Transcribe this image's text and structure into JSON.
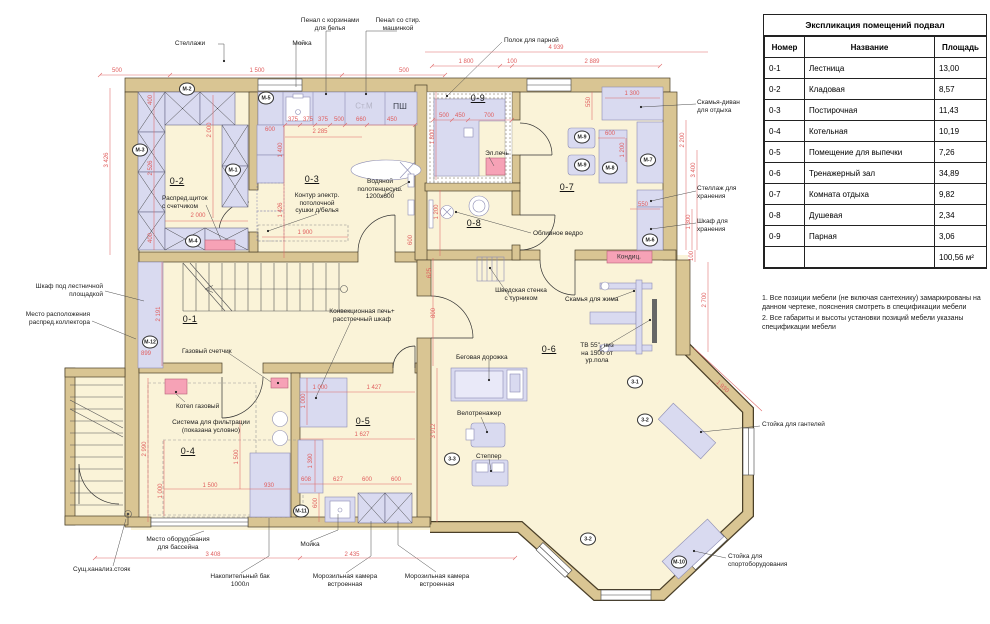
{
  "legend": {
    "title": "Экспликация помещений подвал",
    "columns": [
      "Номер",
      "Название",
      "Площадь"
    ],
    "rows": [
      [
        "0-1",
        "Лестница",
        "13,00"
      ],
      [
        "0-2",
        "Кладовая",
        "8,57"
      ],
      [
        "0-3",
        "Постирочная",
        "11,43"
      ],
      [
        "0-4",
        "Котельная",
        "10,19"
      ],
      [
        "0-5",
        "Помещение для выпечки",
        "7,26"
      ],
      [
        "0-6",
        "Тренажерный зал",
        "34,89"
      ],
      [
        "0-7",
        "Комната отдыха",
        "9,82"
      ],
      [
        "0-8",
        "Душевая",
        "2,34"
      ],
      [
        "0-9",
        "Парная",
        "3,06"
      ]
    ],
    "total": "100,56 м²"
  },
  "notes": [
    "1. Все позиции мебели (не включая сантехнику) замаркированы на данном чертеже, пояснения смотреть в спецификации мебели",
    "2. Все габариты и высоты установки позиций мебели указаны спецификации мебели"
  ],
  "colors": {
    "wall": "#d9c593",
    "floor": "#faf3d8",
    "furniture": "#d9daf0",
    "equipment_pink": "#f6a2b6",
    "dimension_red": "#e05d5d"
  },
  "plan": {
    "room_labels": [
      {
        "t": "0-1",
        "x": 190,
        "y": 314
      },
      {
        "t": "0-2",
        "x": 177,
        "y": 176
      },
      {
        "t": "0-3",
        "x": 312,
        "y": 174
      },
      {
        "t": "0-4",
        "x": 188,
        "y": 446
      },
      {
        "t": "0-5",
        "x": 363,
        "y": 416
      },
      {
        "t": "0-6",
        "x": 549,
        "y": 344
      },
      {
        "t": "0-7",
        "x": 567,
        "y": 182
      },
      {
        "t": "0-8",
        "x": 474,
        "y": 218
      },
      {
        "t": "0-9",
        "x": 478,
        "y": 93
      }
    ],
    "marks": [
      {
        "t": "М-1",
        "x": 233,
        "y": 170
      },
      {
        "t": "М-2",
        "x": 187,
        "y": 89
      },
      {
        "t": "М-3",
        "x": 140,
        "y": 150
      },
      {
        "t": "М-4",
        "x": 193,
        "y": 241
      },
      {
        "t": "М-5",
        "x": 266,
        "y": 98
      },
      {
        "t": "М-6",
        "x": 650,
        "y": 240
      },
      {
        "t": "М-7",
        "x": 648,
        "y": 160
      },
      {
        "t": "М-8",
        "x": 610,
        "y": 168
      },
      {
        "t": "М-9",
        "x": 582,
        "y": 137
      },
      {
        "t": "М-9",
        "x": 582,
        "y": 165
      },
      {
        "t": "М-10",
        "x": 679,
        "y": 562
      },
      {
        "t": "М-11",
        "x": 301,
        "y": 511
      },
      {
        "t": "М-12",
        "x": 150,
        "y": 342
      },
      {
        "t": "3-1",
        "x": 635,
        "y": 382
      },
      {
        "t": "3-2",
        "x": 645,
        "y": 420
      },
      {
        "t": "3-2",
        "x": 588,
        "y": 539
      },
      {
        "t": "3-3",
        "x": 452,
        "y": 459
      }
    ],
    "labels": [
      {
        "t": "Стеллажи",
        "x": 190,
        "y": 40,
        "a": "c"
      },
      {
        "t": "Пенал с корзинами\nдля белья",
        "x": 330,
        "y": 17,
        "a": "c"
      },
      {
        "t": "Пенал со стир.\nмашинкой",
        "x": 398,
        "y": 17,
        "a": "c"
      },
      {
        "t": "Мойка",
        "x": 302,
        "y": 40,
        "a": "c"
      },
      {
        "t": "Полок для парной",
        "x": 504,
        "y": 37,
        "a": "l"
      },
      {
        "t": "Скамья-диван\nдля отдыха",
        "x": 697,
        "y": 99,
        "a": "l"
      },
      {
        "t": "Стеллаж для\nхранения",
        "x": 697,
        "y": 185,
        "a": "l"
      },
      {
        "t": "Шкаф для\nхранения",
        "x": 697,
        "y": 218,
        "a": "l"
      },
      {
        "t": "Распред.щиток\nс счетчиком",
        "x": 162,
        "y": 195,
        "a": "l"
      },
      {
        "t": "Контур электр.\nпотолочной\nсушки д/белья",
        "x": 317,
        "y": 192,
        "a": "c"
      },
      {
        "t": "Водяной\nполотенцесуш.\n1200х600",
        "x": 380,
        "y": 178,
        "a": "c"
      },
      {
        "t": "Эл.печь",
        "x": 497,
        "y": 150,
        "a": "c"
      },
      {
        "t": "Обливное ведро",
        "x": 533,
        "y": 230,
        "a": "l"
      },
      {
        "t": "Шведская стенка\nс турником",
        "x": 521,
        "y": 287,
        "a": "c"
      },
      {
        "t": "Скамья для жима",
        "x": 565,
        "y": 296,
        "a": "l"
      },
      {
        "t": "ТВ 55\", низ\nна 1500 от\nур.пола",
        "x": 597,
        "y": 342,
        "a": "c"
      },
      {
        "t": "Беговая дорожка",
        "x": 456,
        "y": 354,
        "a": "l"
      },
      {
        "t": "Велотренажер",
        "x": 457,
        "y": 410,
        "a": "l"
      },
      {
        "t": "Степпер",
        "x": 476,
        "y": 453,
        "a": "l"
      },
      {
        "t": "Стойка для гантелей",
        "x": 762,
        "y": 421,
        "a": "l"
      },
      {
        "t": "Стойка для\nспортоборудования",
        "x": 728,
        "y": 553,
        "a": "l"
      },
      {
        "t": "Место оборудования\nдля бассейна",
        "x": 178,
        "y": 536,
        "a": "c"
      },
      {
        "t": "Сущ.канализ.стояк",
        "x": 73,
        "y": 566,
        "a": "l"
      },
      {
        "t": "Накопительный бак\n1000л",
        "x": 240,
        "y": 573,
        "a": "c"
      },
      {
        "t": "Морозильная камера\nвстроенная",
        "x": 345,
        "y": 573,
        "a": "c"
      },
      {
        "t": "Морозильная камера\nвстроенная",
        "x": 437,
        "y": 573,
        "a": "c"
      },
      {
        "t": "Мойка",
        "x": 310,
        "y": 541,
        "a": "c"
      },
      {
        "t": "Газовый счетчик",
        "x": 182,
        "y": 348,
        "a": "l"
      },
      {
        "t": "Котел газовый",
        "x": 176,
        "y": 403,
        "a": "l"
      },
      {
        "t": "Система для фильтрации\n(показана условно)",
        "x": 211,
        "y": 419,
        "a": "c"
      },
      {
        "t": "Конвекционная печь+\nрасстоечный шкаф",
        "x": 362,
        "y": 308,
        "a": "c"
      },
      {
        "t": "Шкаф под лестничной\nплощадкой",
        "x": 103,
        "y": 283,
        "a": "r"
      },
      {
        "t": "Место расположения\nраспред.коллектора",
        "x": 90,
        "y": 311,
        "a": "r"
      }
    ],
    "dims": [
      {
        "t": "500",
        "x": 117,
        "y": 71
      },
      {
        "t": "1 500",
        "x": 257,
        "y": 71
      },
      {
        "t": "500",
        "x": 404,
        "y": 71
      },
      {
        "t": "1 800",
        "x": 466,
        "y": 62
      },
      {
        "t": "100",
        "x": 512,
        "y": 62
      },
      {
        "t": "2 889",
        "x": 592,
        "y": 62
      },
      {
        "t": "4 939",
        "x": 556,
        "y": 48
      },
      {
        "t": "3 426",
        "x": 107,
        "y": 160,
        "r": -90
      },
      {
        "t": "2 526",
        "x": 151,
        "y": 168,
        "r": -90
      },
      {
        "t": "400",
        "x": 151,
        "y": 100,
        "r": -90
      },
      {
        "t": "400",
        "x": 151,
        "y": 238,
        "r": -90
      },
      {
        "t": "2 000",
        "x": 210,
        "y": 130,
        "r": -90
      },
      {
        "t": "2 000",
        "x": 198,
        "y": 216
      },
      {
        "t": "600",
        "x": 270,
        "y": 130
      },
      {
        "t": "375",
        "x": 293,
        "y": 120
      },
      {
        "t": "375",
        "x": 308,
        "y": 120
      },
      {
        "t": "375",
        "x": 323,
        "y": 120
      },
      {
        "t": "500",
        "x": 339,
        "y": 120
      },
      {
        "t": "660",
        "x": 361,
        "y": 120
      },
      {
        "t": "450",
        "x": 392,
        "y": 120
      },
      {
        "t": "2 285",
        "x": 320,
        "y": 132
      },
      {
        "t": "1 400",
        "x": 281,
        "y": 150,
        "r": -90
      },
      {
        "t": "1 426",
        "x": 281,
        "y": 210,
        "r": -90
      },
      {
        "t": "1 900",
        "x": 305,
        "y": 233
      },
      {
        "t": "600",
        "x": 411,
        "y": 240,
        "r": -90
      },
      {
        "t": "500",
        "x": 444,
        "y": 116
      },
      {
        "t": "450",
        "x": 460,
        "y": 116
      },
      {
        "t": "700",
        "x": 489,
        "y": 116
      },
      {
        "t": "1 800",
        "x": 433,
        "y": 137,
        "r": -90
      },
      {
        "t": "1 200",
        "x": 437,
        "y": 212,
        "r": -90
      },
      {
        "t": "625",
        "x": 430,
        "y": 273,
        "r": -90
      },
      {
        "t": "800",
        "x": 434,
        "y": 313,
        "r": -90
      },
      {
        "t": "3 912",
        "x": 434,
        "y": 431,
        "r": -90
      },
      {
        "t": "550",
        "x": 589,
        "y": 102,
        "r": -90
      },
      {
        "t": "1 300",
        "x": 632,
        "y": 94
      },
      {
        "t": "600",
        "x": 610,
        "y": 134
      },
      {
        "t": "1 200",
        "x": 623,
        "y": 150,
        "r": -90
      },
      {
        "t": "2 200",
        "x": 683,
        "y": 140,
        "r": -90
      },
      {
        "t": "3 400",
        "x": 694,
        "y": 170,
        "r": -90
      },
      {
        "t": "550",
        "x": 643,
        "y": 205
      },
      {
        "t": "1 300",
        "x": 689,
        "y": 222,
        "r": -90
      },
      {
        "t": "100",
        "x": 692,
        "y": 256,
        "r": -90
      },
      {
        "t": "2 700",
        "x": 705,
        "y": 300,
        "r": -90
      },
      {
        "t": "1 930",
        "x": 722,
        "y": 387,
        "r": 43
      },
      {
        "t": "2 191",
        "x": 159,
        "y": 314,
        "r": -90
      },
      {
        "t": "899",
        "x": 146,
        "y": 354
      },
      {
        "t": "1 000",
        "x": 320,
        "y": 388
      },
      {
        "t": "1 427",
        "x": 374,
        "y": 388
      },
      {
        "t": "1 000",
        "x": 304,
        "y": 401,
        "r": -90
      },
      {
        "t": "1 627",
        "x": 362,
        "y": 435
      },
      {
        "t": "1 390",
        "x": 311,
        "y": 461,
        "r": -90
      },
      {
        "t": "608",
        "x": 306,
        "y": 480
      },
      {
        "t": "627",
        "x": 338,
        "y": 480
      },
      {
        "t": "600",
        "x": 367,
        "y": 480
      },
      {
        "t": "600",
        "x": 396,
        "y": 480
      },
      {
        "t": "600",
        "x": 316,
        "y": 503,
        "r": -90
      },
      {
        "t": "2 990",
        "x": 145,
        "y": 449,
        "r": -90
      },
      {
        "t": "1 000",
        "x": 161,
        "y": 491,
        "r": -90
      },
      {
        "t": "1 500",
        "x": 210,
        "y": 486
      },
      {
        "t": "1 500",
        "x": 237,
        "y": 457,
        "r": -90
      },
      {
        "t": "930",
        "x": 269,
        "y": 486
      },
      {
        "t": "3 408",
        "x": 213,
        "y": 555
      },
      {
        "t": "2 435",
        "x": 352,
        "y": 555
      }
    ],
    "inline_texts": [
      {
        "t": "Ст.М",
        "x": 364,
        "y": 106,
        "cls": "ghost"
      },
      {
        "t": "ПШ",
        "x": 400,
        "y": 106,
        "cls": "dark"
      },
      {
        "t": "Кондиц.",
        "x": 629,
        "y": 257,
        "cls": "pinklbl"
      }
    ]
  }
}
